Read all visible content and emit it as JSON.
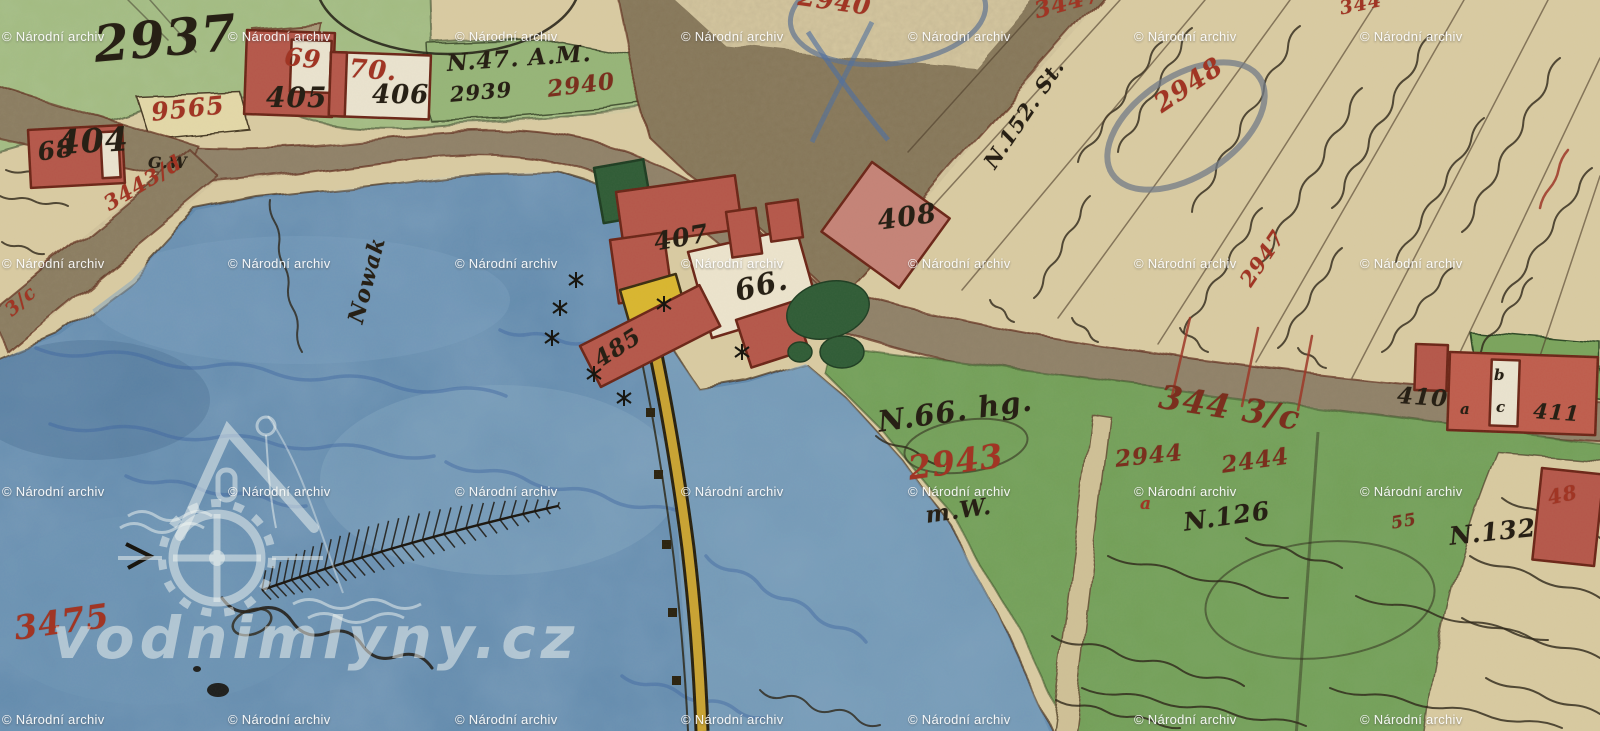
{
  "watermark": {
    "archive_text": "© Národní archiv",
    "site_text": "vodnimlyny.cz",
    "grid": {
      "cols": [
        2,
        228,
        455,
        681,
        908,
        1134,
        1360
      ],
      "rows": [
        29,
        256,
        484,
        712
      ]
    }
  },
  "colors": {
    "paper": "#d9cba2",
    "water": "#6189ad",
    "garden_green": "#a3bc82",
    "meadow_green": "#73a058",
    "road_brown": "#8f8168",
    "building_red": "#b5574a",
    "building_outline": "#6b2517",
    "yellow_building": "#d9b62f",
    "weir_yellow": "#c9a332",
    "black_ink": "#272015",
    "red_ink": "#a13524",
    "dark_red_ink": "#7b2f1e",
    "blue_pencil": "#5d7292",
    "watermark_white": "#ffffff"
  },
  "labels": [
    {
      "name": "parcel-2937",
      "text": "2937",
      "x": 92,
      "y": 20,
      "size": 50,
      "rot": -5,
      "ink": "black"
    },
    {
      "name": "parcel-9565",
      "text": "9565",
      "x": 150,
      "y": 100,
      "size": 25,
      "rot": -6,
      "ink": "red"
    },
    {
      "name": "house-404",
      "text": "404",
      "x": 56,
      "y": 126,
      "size": 33,
      "rot": -3,
      "ink": "black"
    },
    {
      "name": "house-68",
      "text": "68",
      "x": 36,
      "y": 140,
      "size": 25,
      "rot": -8,
      "ink": "black"
    },
    {
      "name": "house-405",
      "text": "405",
      "x": 266,
      "y": 84,
      "size": 28,
      "rot": 0,
      "ink": "black"
    },
    {
      "name": "house-69",
      "text": "69",
      "x": 286,
      "y": 44,
      "size": 25,
      "rot": 6,
      "ink": "red"
    },
    {
      "name": "house-70",
      "text": "70.",
      "x": 350,
      "y": 56,
      "size": 26,
      "rot": 4,
      "ink": "red"
    },
    {
      "name": "house-406",
      "text": "406",
      "x": 372,
      "y": 82,
      "size": 26,
      "rot": 0,
      "ink": "black"
    },
    {
      "name": "note-n47-am",
      "text": "N.47. A.M.",
      "x": 446,
      "y": 52,
      "size": 23,
      "rot": -4,
      "ink": "black"
    },
    {
      "name": "parcel-2939",
      "text": "2939",
      "x": 449,
      "y": 84,
      "size": 21,
      "rot": -5,
      "ink": "black"
    },
    {
      "name": "parcel-2940",
      "text": "2940",
      "x": 546,
      "y": 78,
      "size": 23,
      "rot": -7,
      "ink": "darkred"
    },
    {
      "name": "note-gw",
      "text": "G.W",
      "x": 148,
      "y": 155,
      "size": 16,
      "rot": 0,
      "ink": "black"
    },
    {
      "name": "parcel-3443d",
      "text": "3443/d",
      "x": 100,
      "y": 196,
      "size": 21,
      "rot": -31,
      "ink": "red"
    },
    {
      "name": "parcel-3c-left",
      "text": "3/c",
      "x": 2,
      "y": 306,
      "size": 19,
      "rot": -42,
      "ink": "red"
    },
    {
      "name": "name-nowak",
      "text": "Nowak",
      "x": 345,
      "y": 320,
      "size": 22,
      "rot": -75,
      "ink": "black"
    },
    {
      "name": "house-407",
      "text": "407",
      "x": 652,
      "y": 230,
      "size": 25,
      "rot": -10,
      "ink": "black"
    },
    {
      "name": "house-66",
      "text": "66.",
      "x": 732,
      "y": 278,
      "size": 29,
      "rot": -14,
      "ink": "black"
    },
    {
      "name": "house-408",
      "text": "408",
      "x": 876,
      "y": 208,
      "size": 27,
      "rot": -8,
      "ink": "black"
    },
    {
      "name": "house-485",
      "text": "485",
      "x": 590,
      "y": 352,
      "size": 23,
      "rot": -33,
      "ink": "black"
    },
    {
      "name": "parcel-2940-oval",
      "text": "2940",
      "x": 800,
      "y": -16,
      "size": 25,
      "rot": 8,
      "ink": "red"
    },
    {
      "name": "parcel-3447-top",
      "text": "3447",
      "x": 1032,
      "y": 0,
      "size": 23,
      "rot": -15,
      "ink": "red"
    },
    {
      "name": "parcel-344-top",
      "text": "344",
      "x": 1338,
      "y": 0,
      "size": 19,
      "rot": -12,
      "ink": "red"
    },
    {
      "name": "parcel-2948",
      "text": "2948",
      "x": 1150,
      "y": 96,
      "size": 26,
      "rot": -34,
      "ink": "red"
    },
    {
      "name": "note-n152-st",
      "text": "N.152. St.",
      "x": 980,
      "y": 160,
      "size": 21,
      "rot": -56,
      "ink": "black"
    },
    {
      "name": "parcel-2947",
      "text": "2947",
      "x": 1236,
      "y": 278,
      "size": 21,
      "rot": -56,
      "ink": "red"
    },
    {
      "name": "road-344-3c",
      "text": "344 3/c",
      "x": 1162,
      "y": 380,
      "size": 33,
      "rot": 9,
      "ink": "darkred"
    },
    {
      "name": "house-410",
      "text": "410",
      "x": 1398,
      "y": 384,
      "size": 23,
      "rot": 4,
      "ink": "black"
    },
    {
      "name": "house-410-a",
      "text": "a",
      "x": 1460,
      "y": 402,
      "size": 15,
      "rot": 0,
      "ink": "black"
    },
    {
      "name": "house-410-b",
      "text": "b",
      "x": 1494,
      "y": 368,
      "size": 15,
      "rot": 0,
      "ink": "black"
    },
    {
      "name": "house-410-c",
      "text": "c",
      "x": 1496,
      "y": 400,
      "size": 15,
      "rot": 0,
      "ink": "black"
    },
    {
      "name": "house-411",
      "text": "411",
      "x": 1534,
      "y": 400,
      "size": 21,
      "rot": 4,
      "ink": "black"
    },
    {
      "name": "note-n66-hg",
      "text": "N.66. hg.",
      "x": 876,
      "y": 408,
      "size": 29,
      "rot": -8,
      "ink": "black"
    },
    {
      "name": "parcel-2943",
      "text": "2943",
      "x": 906,
      "y": 452,
      "size": 33,
      "rot": -8,
      "ink": "red"
    },
    {
      "name": "note-mw",
      "text": "m.W.",
      "x": 924,
      "y": 504,
      "size": 23,
      "rot": -8,
      "ink": "black"
    },
    {
      "name": "parcel-2944",
      "text": "2944",
      "x": 1114,
      "y": 448,
      "size": 23,
      "rot": -6,
      "ink": "darkred"
    },
    {
      "name": "parcel-2444",
      "text": "2444",
      "x": 1220,
      "y": 454,
      "size": 23,
      "rot": -8,
      "ink": "darkred"
    },
    {
      "name": "parcel-2944-a",
      "text": "a",
      "x": 1140,
      "y": 496,
      "size": 17,
      "rot": 0,
      "ink": "red"
    },
    {
      "name": "note-n126",
      "text": "N.126",
      "x": 1182,
      "y": 510,
      "size": 25,
      "rot": -8,
      "ink": "black"
    },
    {
      "name": "parcel-55",
      "text": "55",
      "x": 1390,
      "y": 516,
      "size": 17,
      "rot": -10,
      "ink": "darkred"
    },
    {
      "name": "note-n132",
      "text": "N.132",
      "x": 1448,
      "y": 524,
      "size": 25,
      "rot": -6,
      "ink": "black"
    },
    {
      "name": "parcel-3475",
      "text": "3475",
      "x": 12,
      "y": 612,
      "size": 33,
      "rot": -8,
      "ink": "red"
    },
    {
      "name": "parcel-48-right",
      "text": "48",
      "x": 1546,
      "y": 488,
      "size": 20,
      "rot": -12,
      "ink": "red"
    }
  ]
}
